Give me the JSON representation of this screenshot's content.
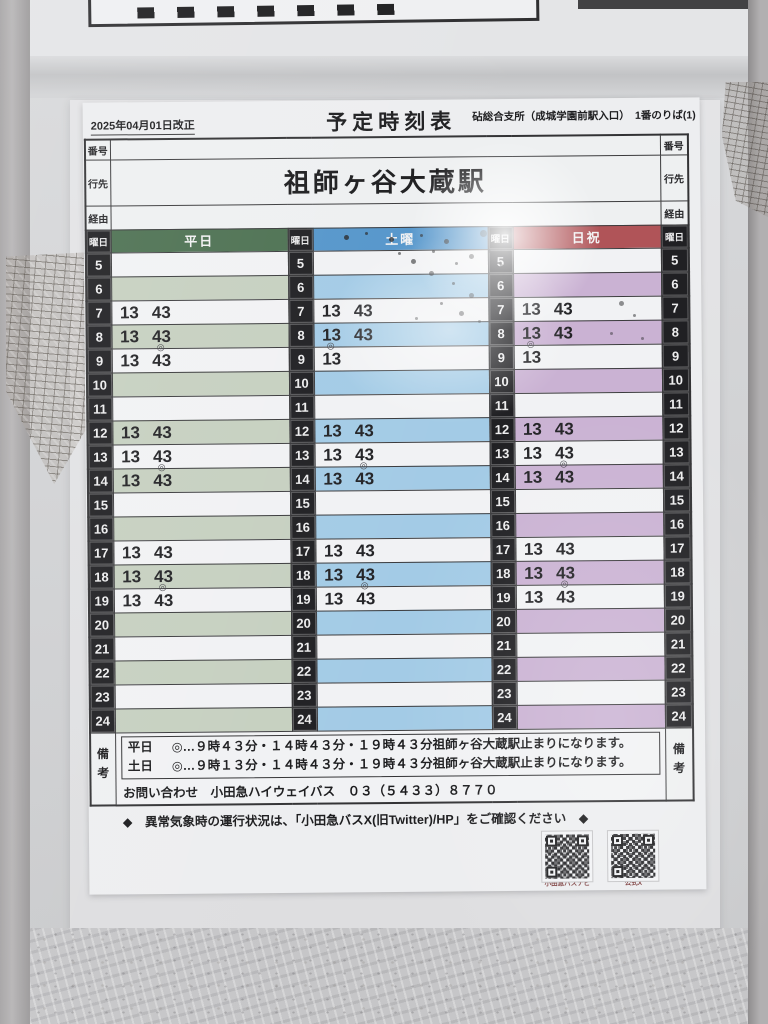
{
  "header": {
    "revision_date": "2025年04月01日改正",
    "title": "予定時刻表",
    "stop_info": "砧総合支所（成城学園前駅入口）　1番のりば(1)"
  },
  "row_labels": {
    "number": "番号",
    "destination": "行先",
    "via": "経由",
    "day": "曜日",
    "remarks": "備考"
  },
  "destination": "祖師ヶ谷大蔵駅",
  "via_value": "",
  "number_value": "",
  "columns": [
    {
      "id": "weekday",
      "label": "平日"
    },
    {
      "id": "saturday",
      "label": "土曜"
    },
    {
      "id": "sunday",
      "label": "日祝"
    }
  ],
  "colors": {
    "weekday_header": "#4d7152",
    "weekday_band": "#c6d0c0",
    "saturday_header": "#5596cb",
    "saturday_band": "#a3cbe6",
    "sunday_header": "#b05458",
    "sunday_band": "#cab2d3"
  },
  "ring_symbol": "◎",
  "timetable": {
    "rows": [
      {
        "hour": "5",
        "weekday": [],
        "saturday": [],
        "sunday": []
      },
      {
        "hour": "6",
        "weekday": [],
        "saturday": [],
        "sunday": []
      },
      {
        "hour": "7",
        "weekday": [
          {
            "t": "13"
          },
          {
            "t": "43"
          }
        ],
        "saturday": [
          {
            "t": "13"
          },
          {
            "t": "43"
          }
        ],
        "sunday": [
          {
            "t": "13"
          },
          {
            "t": "43"
          }
        ]
      },
      {
        "hour": "8",
        "weekday": [
          {
            "t": "13"
          },
          {
            "t": "43"
          }
        ],
        "saturday": [
          {
            "t": "13"
          },
          {
            "t": "43"
          }
        ],
        "sunday": [
          {
            "t": "13"
          },
          {
            "t": "43"
          }
        ]
      },
      {
        "hour": "9",
        "weekday": [
          {
            "t": "13"
          },
          {
            "t": "43",
            "ring": true
          }
        ],
        "saturday": [
          {
            "t": "13",
            "ring": true
          }
        ],
        "sunday": [
          {
            "t": "13",
            "ring": true
          }
        ]
      },
      {
        "hour": "10",
        "weekday": [],
        "saturday": [],
        "sunday": []
      },
      {
        "hour": "11",
        "weekday": [],
        "saturday": [],
        "sunday": []
      },
      {
        "hour": "12",
        "weekday": [
          {
            "t": "13"
          },
          {
            "t": "43"
          }
        ],
        "saturday": [
          {
            "t": "13"
          },
          {
            "t": "43"
          }
        ],
        "sunday": [
          {
            "t": "13"
          },
          {
            "t": "43"
          }
        ]
      },
      {
        "hour": "13",
        "weekday": [
          {
            "t": "13"
          },
          {
            "t": "43"
          }
        ],
        "saturday": [
          {
            "t": "13"
          },
          {
            "t": "43"
          }
        ],
        "sunday": [
          {
            "t": "13"
          },
          {
            "t": "43"
          }
        ]
      },
      {
        "hour": "14",
        "weekday": [
          {
            "t": "13"
          },
          {
            "t": "43",
            "ring": true
          }
        ],
        "saturday": [
          {
            "t": "13"
          },
          {
            "t": "43",
            "ring": true
          }
        ],
        "sunday": [
          {
            "t": "13"
          },
          {
            "t": "43",
            "ring": true
          }
        ]
      },
      {
        "hour": "15",
        "weekday": [],
        "saturday": [],
        "sunday": []
      },
      {
        "hour": "16",
        "weekday": [],
        "saturday": [],
        "sunday": []
      },
      {
        "hour": "17",
        "weekday": [
          {
            "t": "13"
          },
          {
            "t": "43"
          }
        ],
        "saturday": [
          {
            "t": "13"
          },
          {
            "t": "43"
          }
        ],
        "sunday": [
          {
            "t": "13"
          },
          {
            "t": "43"
          }
        ]
      },
      {
        "hour": "18",
        "weekday": [
          {
            "t": "13"
          },
          {
            "t": "43"
          }
        ],
        "saturday": [
          {
            "t": "13"
          },
          {
            "t": "43"
          }
        ],
        "sunday": [
          {
            "t": "13"
          },
          {
            "t": "43"
          }
        ]
      },
      {
        "hour": "19",
        "weekday": [
          {
            "t": "13"
          },
          {
            "t": "43",
            "ring": true
          }
        ],
        "saturday": [
          {
            "t": "13"
          },
          {
            "t": "43",
            "ring": true
          }
        ],
        "sunday": [
          {
            "t": "13"
          },
          {
            "t": "43",
            "ring": true
          }
        ]
      },
      {
        "hour": "20",
        "weekday": [],
        "saturday": [],
        "sunday": []
      },
      {
        "hour": "21",
        "weekday": [],
        "saturday": [],
        "sunday": []
      },
      {
        "hour": "22",
        "weekday": [],
        "saturday": [],
        "sunday": []
      },
      {
        "hour": "23",
        "weekday": [],
        "saturday": [],
        "sunday": []
      },
      {
        "hour": "24",
        "weekday": [],
        "saturday": [],
        "sunday": []
      }
    ]
  },
  "remarks": {
    "notes": [
      {
        "day": "平日",
        "text": "◎…９時４３分・１４時４３分・１９時４３分祖師ヶ谷大蔵駅止まりになります。"
      },
      {
        "day": "土日",
        "text": "◎…９時１３分・１４時４３分・１９時４３分祖師ヶ谷大蔵駅止まりになります。"
      }
    ],
    "contact": "お問い合わせ　小田急ハイウェイバス　０３（５４３３）８７７０"
  },
  "footer": {
    "weather_note": "◆　異常気象時の運行状況は、「小田急バスX(旧Twitter)/HP」をご確認ください　◆",
    "qr_codes": [
      {
        "label": "小田急バスナビ"
      },
      {
        "label": "公式X"
      }
    ]
  }
}
